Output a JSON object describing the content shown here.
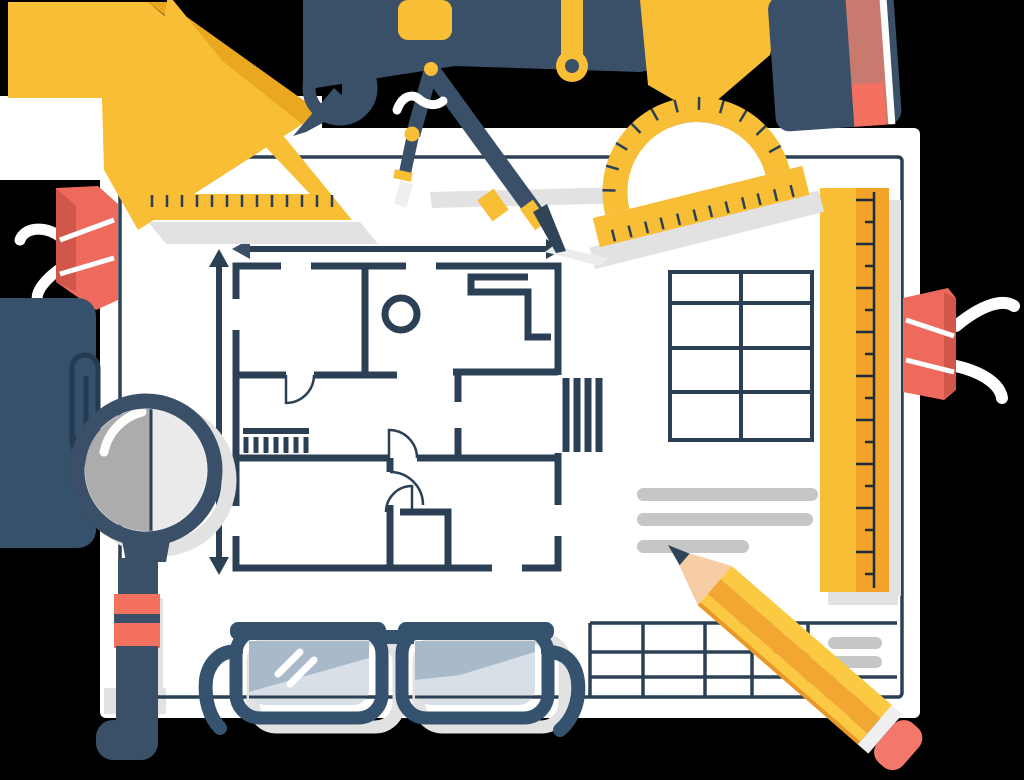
{
  "scene": {
    "description": "Flat vector illustration: architectural floor plan blueprint sheet surrounded by drafting tools - set square, protractor, compass, T-square bar, ruler, eraser, pencil, magnifying glass, eyeglasses, binder clips, paper clip and notebook",
    "background_color": "#000000"
  },
  "colors": {
    "yellow": "#F8BE35",
    "yellow_shade": "#E9A81F",
    "orange": "#F2A32A",
    "navy": "#3A5068",
    "plan": "#2B4055",
    "slate": "#35516B",
    "paper": "#FFFFFF",
    "salmon": "#F4705F",
    "salmon_dusty": "#C87A6F",
    "clip_red": "#ED6A5C",
    "clip_red_dark": "#D1574B",
    "shadow_gray": "#E2E2E2",
    "placeholder_gray": "#C6C6C6",
    "lens_light": "#EAEAEA",
    "lens_dark": "#ACACAC",
    "glasses": "#35536E",
    "glasses_lens": "#D8DFE7",
    "glasses_lens_dark": "#A8B9CA",
    "pencil_wood": "#F6CDA4",
    "pencil_yellow": "#FCCA42",
    "pencil_orange": "#F3A733",
    "lead": "#2F4456",
    "paperclip": "#243B52"
  },
  "objects": [
    "blueprint sheet",
    "floor plan",
    "dimension arrows",
    "set square",
    "protractor",
    "drafting compass",
    "t-square bar",
    "ruler",
    "eraser",
    "pencil",
    "magnifying glass",
    "eyeglasses",
    "left binder clip",
    "right binder clip",
    "paper clip",
    "notebook"
  ],
  "floor_plan": {
    "dimension_arrows": 2,
    "doors": 4,
    "window_openings": 6,
    "stair_symbol": 1,
    "column_circle": 1,
    "hatch_symbols": 2
  },
  "tables": {
    "right_table": {
      "rows": 4,
      "columns": 2
    },
    "bottom_table": {
      "rows": 3,
      "columns": 6
    }
  },
  "placeholder_lines": {
    "left_group": 3,
    "right_group": 2
  },
  "ticks": {
    "ruler": 18,
    "protractor_arc": 11,
    "protractor_base": 12,
    "set_square": 13
  }
}
